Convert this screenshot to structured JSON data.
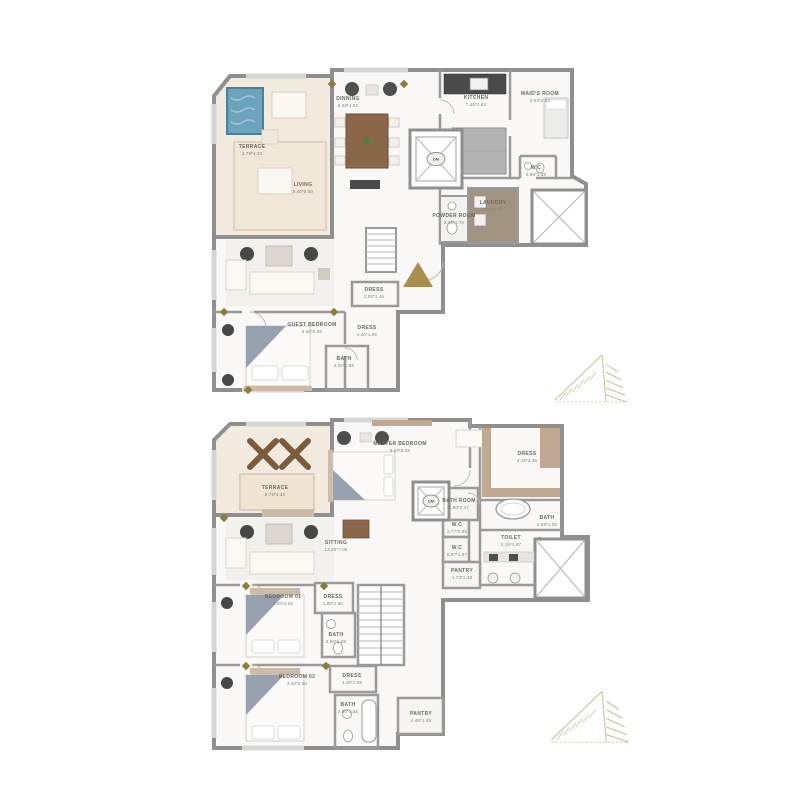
{
  "page": {
    "title": "Duplex floor plans"
  },
  "colors": {
    "wall_gray": "#8f8f8f",
    "partition_gray": "#9a9a9a",
    "floor_white": "#f9f8f6",
    "terrace_beige": "#f3ebdf",
    "pool_blue": "#6ca3bd",
    "wood_brown": "#8a674b",
    "laundry_wood": "#8d7a64",
    "tan_trim": "#c0a893",
    "accent_gold": "#a98e4e",
    "logo_gold": "#c9b382",
    "throw_gray": "#98a1b0",
    "label_text": "#6f675c"
  },
  "plans": [
    {
      "id": "upper-plan",
      "rooms": [
        {
          "name": "TERRACE",
          "dims": "3.79*4.33",
          "x": 252,
          "y": 150
        },
        {
          "name": "DINNING",
          "dims": "6.48*4.92",
          "x": 348,
          "y": 102
        },
        {
          "name": "KITCHEN",
          "dims": "7.40*2.92",
          "x": 476,
          "y": 101
        },
        {
          "name": "MAID'S ROOM",
          "dims": "4.03*2.03",
          "x": 540,
          "y": 97
        },
        {
          "name": "W.C",
          "dims": "0.85*1.38",
          "x": 536,
          "y": 171
        },
        {
          "name": "LAUNDRY",
          "dims": "4.29*2.27",
          "x": 493,
          "y": 206
        },
        {
          "name": "POWDER ROOM",
          "dims": "2.20*1.70",
          "x": 454,
          "y": 219
        },
        {
          "name": "LIVING",
          "dims": "6.40*5.00",
          "x": 303,
          "y": 188
        },
        {
          "name": "DRESS",
          "dims": "2.00*1.45",
          "x": 374,
          "y": 293
        },
        {
          "name": "GUEST BEDROOM",
          "dims": "5.60*5.00",
          "x": 312,
          "y": 328
        },
        {
          "name": "DRESS",
          "dims": "4.30*1.05",
          "x": 367,
          "y": 331
        },
        {
          "name": "BATH",
          "dims": "2.00*1.85",
          "x": 344,
          "y": 362
        },
        {
          "name": "DM",
          "dims": "",
          "x": 436,
          "y": 159,
          "cls": "lift"
        }
      ]
    },
    {
      "id": "lower-plan",
      "rooms": [
        {
          "name": "TERRACE",
          "dims": "5.79*4.33",
          "x": 275,
          "y": 491
        },
        {
          "name": "MASTER BEDROOM",
          "dims": "5.60*5.35",
          "x": 400,
          "y": 447
        },
        {
          "name": "DRESS",
          "dims": "4.39*3.38",
          "x": 527,
          "y": 457
        },
        {
          "name": "BATH",
          "dims": "2.68*1.36",
          "x": 547,
          "y": 521
        },
        {
          "name": "TOILET",
          "dims": "2.19*1.87",
          "x": 511,
          "y": 541
        },
        {
          "name": "BATH ROOM",
          "dims": "1.80*2.17",
          "x": 459,
          "y": 504
        },
        {
          "name": "W.C",
          "dims": "1.77*0.85",
          "x": 457,
          "y": 528
        },
        {
          "name": "W.C",
          "dims": "0.97*1.87",
          "x": 457,
          "y": 551
        },
        {
          "name": "PANTRY",
          "dims": "1.73*1.38",
          "x": 462,
          "y": 574
        },
        {
          "name": "SITTING",
          "dims": "13.20*7.00",
          "x": 336,
          "y": 546
        },
        {
          "name": "BEDROOM 01",
          "dims": "3.40*4.50",
          "x": 283,
          "y": 600
        },
        {
          "name": "DRESS",
          "dims": "1.80*1.60",
          "x": 333,
          "y": 600
        },
        {
          "name": "BATH",
          "dims": "2.60*1.58",
          "x": 336,
          "y": 638
        },
        {
          "name": "BEDROOM 02",
          "dims": "3.40*5.30",
          "x": 297,
          "y": 680
        },
        {
          "name": "DRESS",
          "dims": "4.40*1.05",
          "x": 352,
          "y": 679
        },
        {
          "name": "BATH",
          "dims": "2.60*1.65",
          "x": 348,
          "y": 708
        },
        {
          "name": "PANTRY",
          "dims": "4.40*1.45",
          "x": 421,
          "y": 717
        },
        {
          "name": "DM",
          "dims": "",
          "x": 431,
          "y": 501,
          "cls": "lift"
        }
      ]
    }
  ]
}
